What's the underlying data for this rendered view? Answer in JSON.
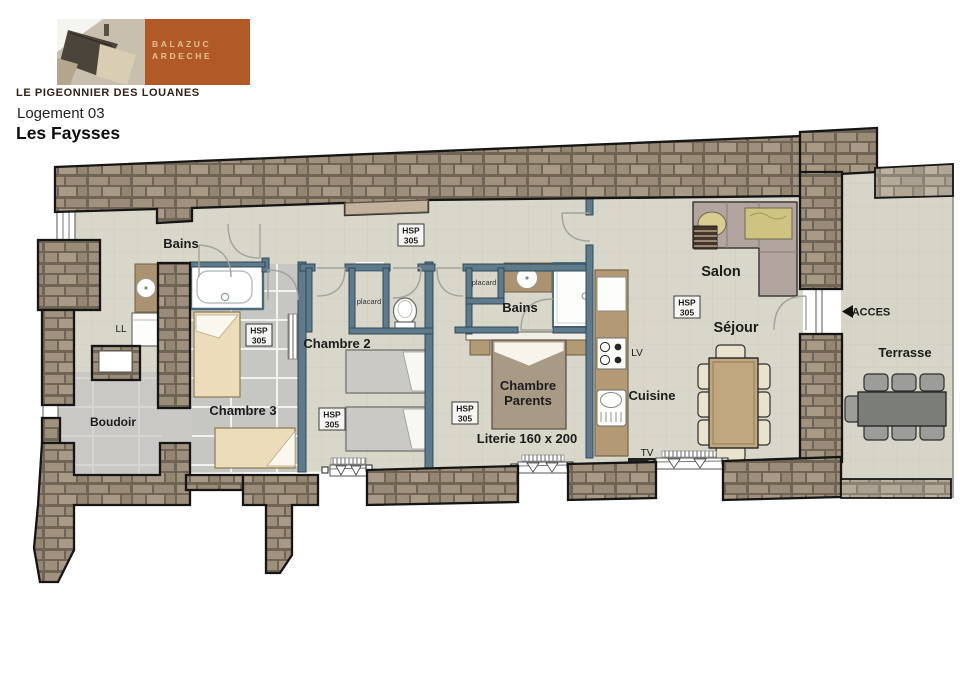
{
  "header": {
    "brand_line1": "BALAZUC",
    "brand_line2": "ARDECHE",
    "site_name": "LE PIGEONNIER DES LOUANES",
    "unit_label": "Logement 03",
    "unit_name": "Les Faysses"
  },
  "plan": {
    "rooms": {
      "bains": "Bains",
      "chambre2": "Chambre 2",
      "chambre3": "Chambre 3",
      "chambre_parents_line1": "Chambre",
      "chambre_parents_line2": "Parents",
      "boudoir": "Boudoir",
      "salon": "Salon",
      "sejour": "Séjour",
      "cuisine": "Cuisine",
      "terrasse": "Terrasse"
    },
    "annotations": {
      "ll": "LL",
      "lv": "LV",
      "tv": "TV",
      "placard": "placard",
      "acces": "ACCES",
      "literie": "Literie 160 x 200",
      "hsp_line1": "HSP",
      "hsp_line2": "305"
    },
    "colors": {
      "accent_orange": "#b15a28",
      "wall_stone": "#9a8c79",
      "partition": "#5f7b8b",
      "floor": "#d9d7c9",
      "tile_floor": "#c6c6c3"
    }
  }
}
